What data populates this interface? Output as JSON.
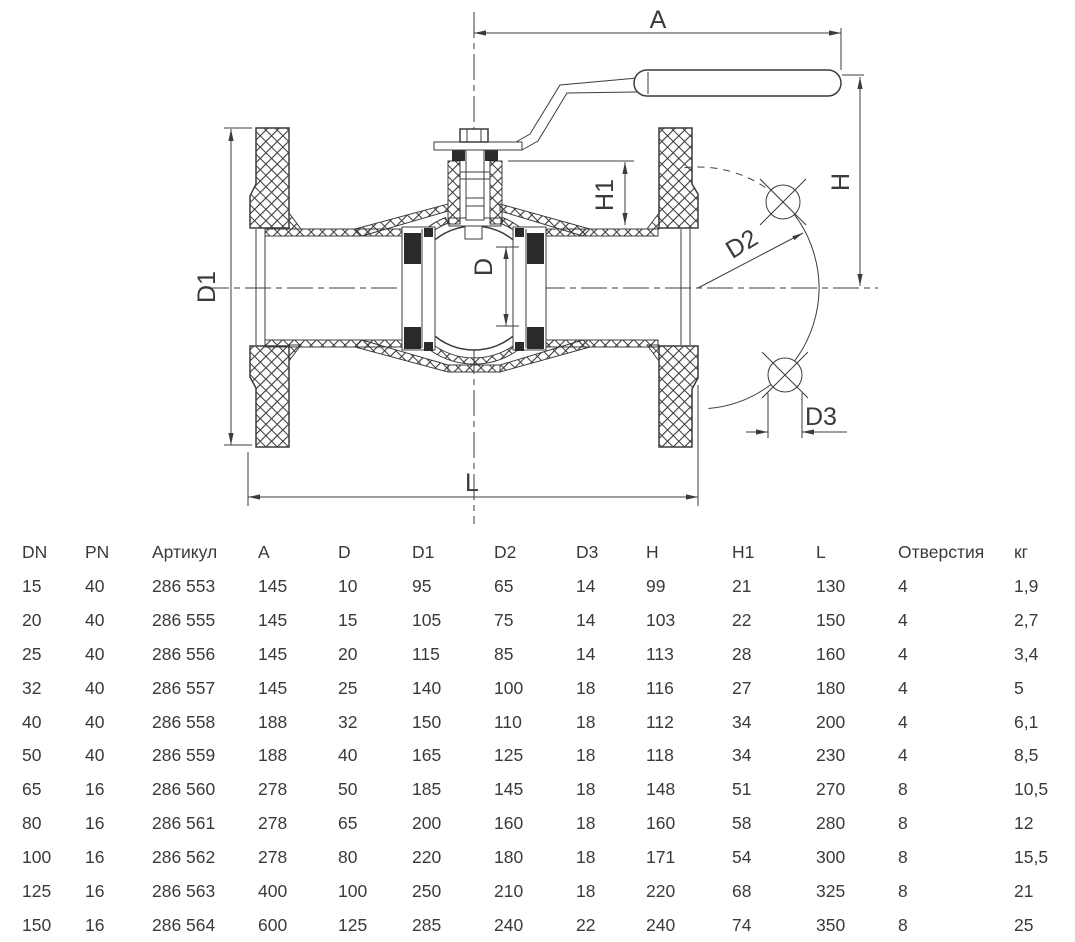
{
  "drawing": {
    "line_color": "#3c3c3c",
    "labels": {
      "a": "A",
      "h": "H",
      "h1": "H1",
      "d": "D",
      "d1": "D1",
      "d2": "D2",
      "d3": "D3",
      "l": "L"
    }
  },
  "table": {
    "headers": [
      "DN",
      "PN",
      "Артикул",
      "A",
      "D",
      "D1",
      "D2",
      "D3",
      "H",
      "H1",
      "L",
      "Отверстия",
      "кг"
    ],
    "rows": [
      [
        "15",
        "40",
        "286 553",
        "145",
        "10",
        "95",
        "65",
        "14",
        "99",
        "21",
        "130",
        "4",
        "1,9"
      ],
      [
        "20",
        "40",
        "286 555",
        "145",
        "15",
        "105",
        "75",
        "14",
        "103",
        "22",
        "150",
        "4",
        "2,7"
      ],
      [
        "25",
        "40",
        "286 556",
        "145",
        "20",
        "115",
        "85",
        "14",
        "113",
        "28",
        "160",
        "4",
        "3,4"
      ],
      [
        "32",
        "40",
        "286 557",
        "145",
        "25",
        "140",
        "100",
        "18",
        "116",
        "27",
        "180",
        "4",
        "5"
      ],
      [
        "40",
        "40",
        "286 558",
        "188",
        "32",
        "150",
        "110",
        "18",
        "112",
        "34",
        "200",
        "4",
        "6,1"
      ],
      [
        "50",
        "40",
        "286 559",
        "188",
        "40",
        "165",
        "125",
        "18",
        "118",
        "34",
        "230",
        "4",
        "8,5"
      ],
      [
        "65",
        "16",
        "286 560",
        "278",
        "50",
        "185",
        "145",
        "18",
        "148",
        "51",
        "270",
        "8",
        "10,5"
      ],
      [
        "80",
        "16",
        "286 561",
        "278",
        "65",
        "200",
        "160",
        "18",
        "160",
        "58",
        "280",
        "8",
        "12"
      ],
      [
        "100",
        "16",
        "286 562",
        "278",
        "80",
        "220",
        "180",
        "18",
        "171",
        "54",
        "300",
        "8",
        "15,5"
      ],
      [
        "125",
        "16",
        "286 563",
        "400",
        "100",
        "250",
        "210",
        "18",
        "220",
        "68",
        "325",
        "8",
        "21"
      ],
      [
        "150",
        "16",
        "286 564",
        "600",
        "125",
        "285",
        "240",
        "22",
        "240",
        "74",
        "350",
        "8",
        "25"
      ]
    ]
  }
}
